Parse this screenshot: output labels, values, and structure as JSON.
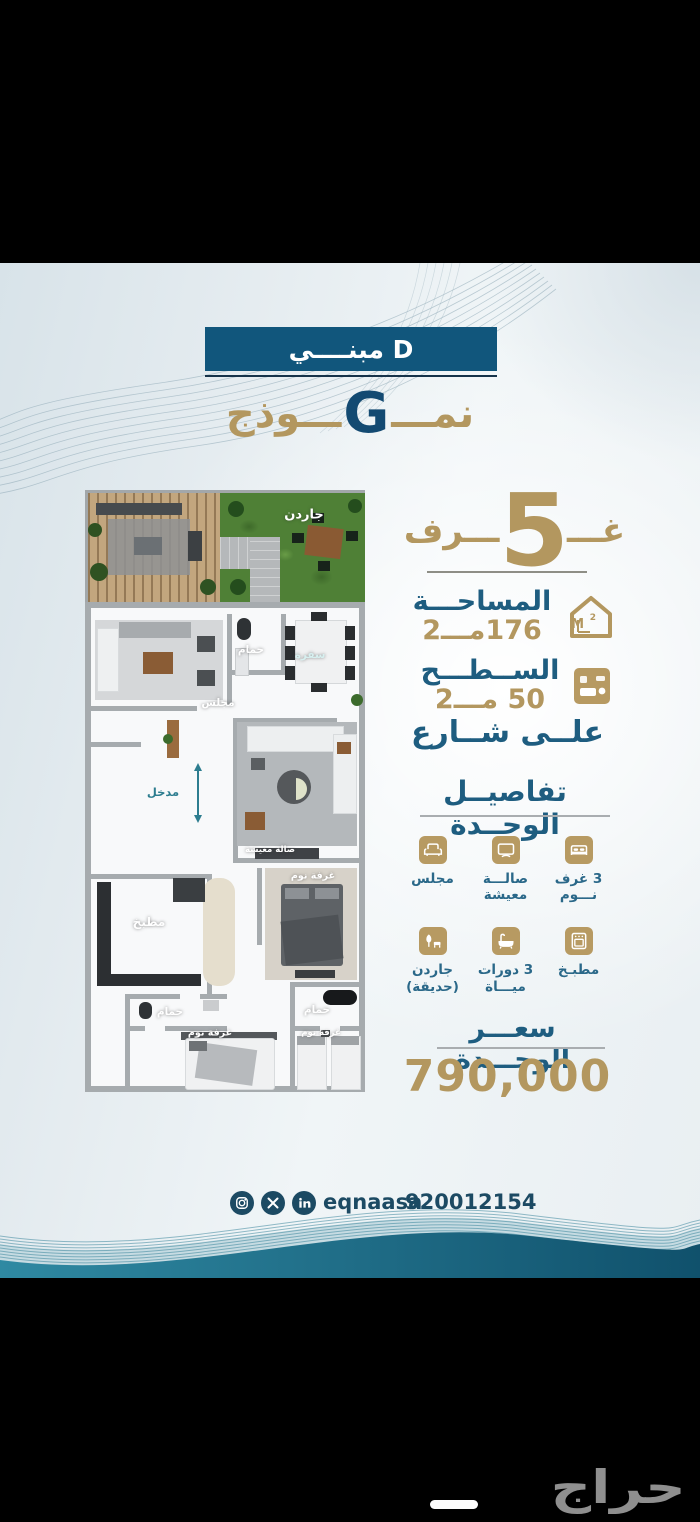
{
  "header": {
    "building": "مبنــــي D",
    "model_prefix": "نمـــ",
    "model_letter": "G",
    "model_suffix": "ـــوذج"
  },
  "floorplan": {
    "labels": {
      "garden": "جاردن",
      "majlis": "مجلس",
      "bath": "حمام",
      "dining": "سفرة",
      "entrance": "مدخل",
      "living": "صالة معيشة",
      "kitchen": "مطبخ",
      "bedroom": "غرفة نوم"
    }
  },
  "stats": {
    "rooms": {
      "prefix": "غـــ",
      "count": "5",
      "suffix": "ـــرف"
    },
    "area": {
      "label": "المساحـــة",
      "value": "176مـــ2"
    },
    "roof": {
      "label": "الســطـــح",
      "value": "50 مـــ2"
    },
    "street": "علــى شــارع"
  },
  "details": {
    "title": "تفاصيــل الوحــدة",
    "items": [
      {
        "icon": "bed-icon",
        "label": "3 غرف\nنـــوم"
      },
      {
        "icon": "tv-icon",
        "label": "صالـــة\nمعيشة"
      },
      {
        "icon": "armchair-icon",
        "label": "مجلس"
      },
      {
        "icon": "oven-icon",
        "label": "مطبـخ"
      },
      {
        "icon": "bath-icon",
        "label": "3 دورات\nميـــاة"
      },
      {
        "icon": "garden-icon",
        "label": "جاردن\n(حديقة)"
      }
    ]
  },
  "price": {
    "title": "سعـــر الوحـــدة",
    "value": "790,000"
  },
  "contact": {
    "handle": "eqnaasa",
    "phone": "920012154",
    "social": [
      "instagram-icon",
      "x-icon",
      "linkedin-icon"
    ]
  },
  "watermark": "حراج",
  "colors": {
    "navy": "#11567c",
    "gold": "#b3975f",
    "blue": "#1e5d80",
    "teal": "#2c7e96"
  }
}
